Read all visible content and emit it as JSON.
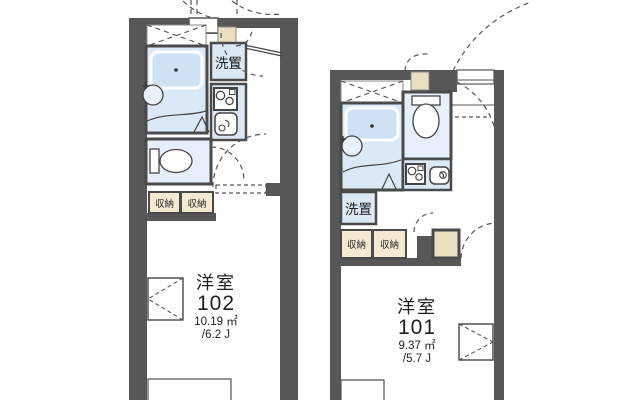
{
  "plan_type": "apartment-floor-plan",
  "units": [
    {
      "number": "102",
      "type_label": "洋室",
      "area_m2": "10.19 ㎡",
      "area_tatami": "/6.2 J",
      "washer_label": "洗置",
      "storage_labels": [
        "収納",
        "収納"
      ]
    },
    {
      "number": "101",
      "type_label": "洋室",
      "area_m2": "9.37 ㎡",
      "area_tatami": "/5.7 J",
      "washer_label": "洗置",
      "storage_labels": [
        "収納",
        "収納"
      ]
    }
  ],
  "colors": {
    "wall": "#575757",
    "fixture_fill": "#dbe8f6",
    "toilet_room_fill": "#e6effa",
    "tub_fill": "#cfe2f4",
    "storage_fill": "#f4ead2",
    "genkan_fill": "#eadfc0",
    "line": "#444444",
    "dash_line": "#555555",
    "text": "#1f1f1f",
    "background": "#ffffff"
  }
}
